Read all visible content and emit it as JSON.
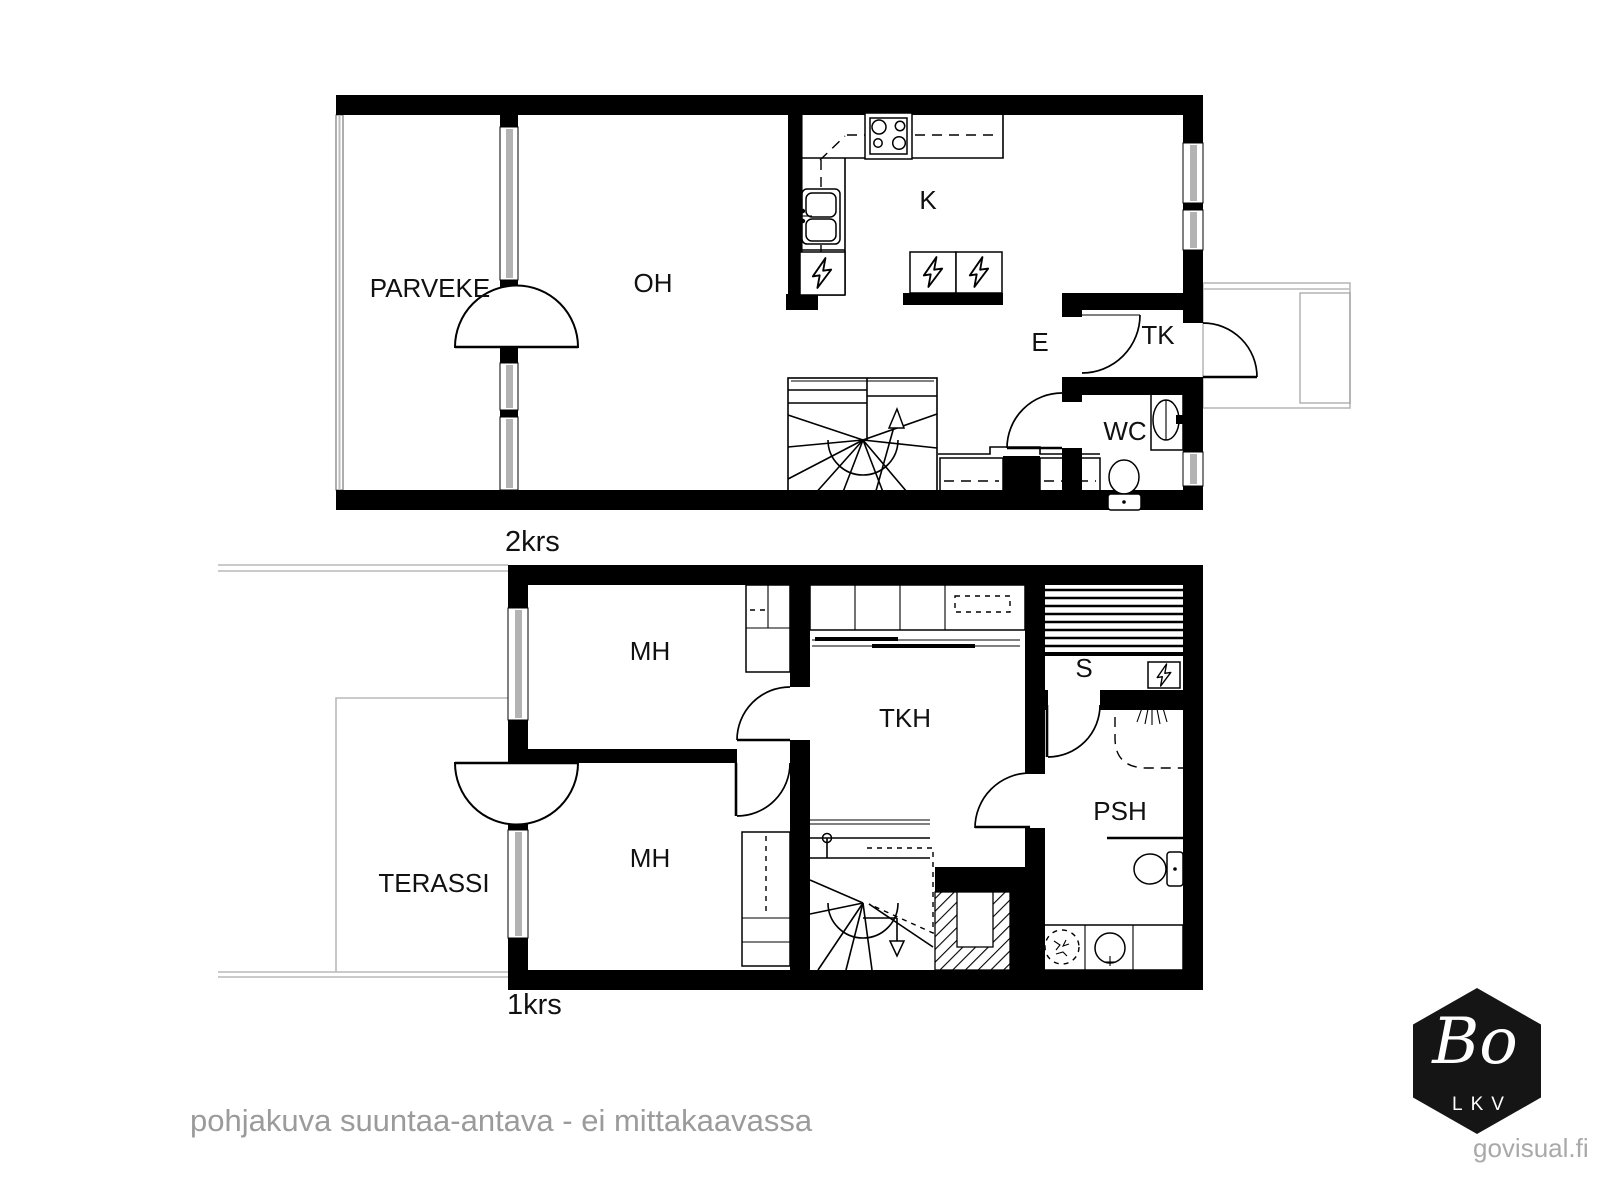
{
  "plan": {
    "floor2": {
      "floor_label": "2krs",
      "rooms": {
        "parveke": "PARVEKE",
        "oh": "OH",
        "k": "K",
        "e": "E",
        "tk": "TK",
        "wc": "WC"
      }
    },
    "floor1": {
      "floor_label": "1krs",
      "rooms": {
        "mh_upper": "MH",
        "mh_lower": "MH",
        "tkh": "TKH",
        "s": "S",
        "psh": "PSH",
        "terassi": "TERASSI"
      }
    }
  },
  "footer": {
    "disclaimer": "pohjakuva suuntaa-antava - ei mittakaavassa"
  },
  "branding": {
    "logo_text": "Bo",
    "logo_subtext": "LKV",
    "website": "govisual.fi"
  },
  "colors": {
    "wall": "#000000",
    "window_fill": "#b3b3b3",
    "outline_gray": "#b9b9b9",
    "disclaimer_text": "#9b9b9b",
    "website_text": "#a9a9a9",
    "logo_background": "#151515",
    "logo_text_color": "#ffffff"
  }
}
